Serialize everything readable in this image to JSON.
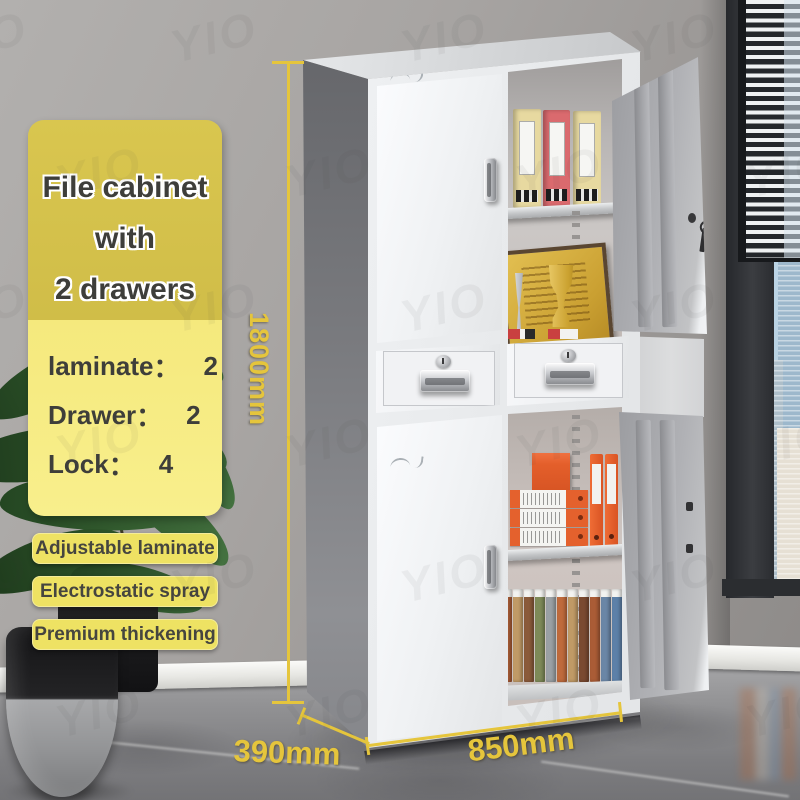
{
  "watermark": {
    "text": "YIO"
  },
  "panel": {
    "title_lines": [
      "File cabinet",
      "with",
      "2 drawers"
    ],
    "specs": [
      {
        "label": "laminate",
        "colon": "：",
        "value": "2"
      },
      {
        "label": "Drawer",
        "colon": "：",
        "value": "2"
      },
      {
        "label": "Lock",
        "colon": "：",
        "value": "4"
      }
    ],
    "pills": [
      "Adjustable laminate",
      "Electrostatic spray",
      "Premium thickening"
    ]
  },
  "dimensions": {
    "height_label": "1800mm",
    "depth_label": "390mm",
    "width_label": "850mm"
  },
  "colors": {
    "panel_top": "#d9c64f",
    "panel_bottom": "#f5e97d",
    "pill_bg": "#eee263",
    "dim_line": "#e5c53c",
    "ink": "#3e3e3a",
    "binder_orange": "#e4612d"
  },
  "cabinet_contents": {
    "top_binder_colors": [
      "#e7d9a0",
      "#da6a6e",
      "#e7d9a0"
    ],
    "book_spine_colors": [
      "#a85c36",
      "#c09a66",
      "#8a5a3a",
      "#7e8a58",
      "#9aa0a4",
      "#bf6a3c",
      "#c09a66",
      "#7a4a31",
      "#aa5c36",
      "#6a86a6",
      "#5d80a8"
    ]
  }
}
